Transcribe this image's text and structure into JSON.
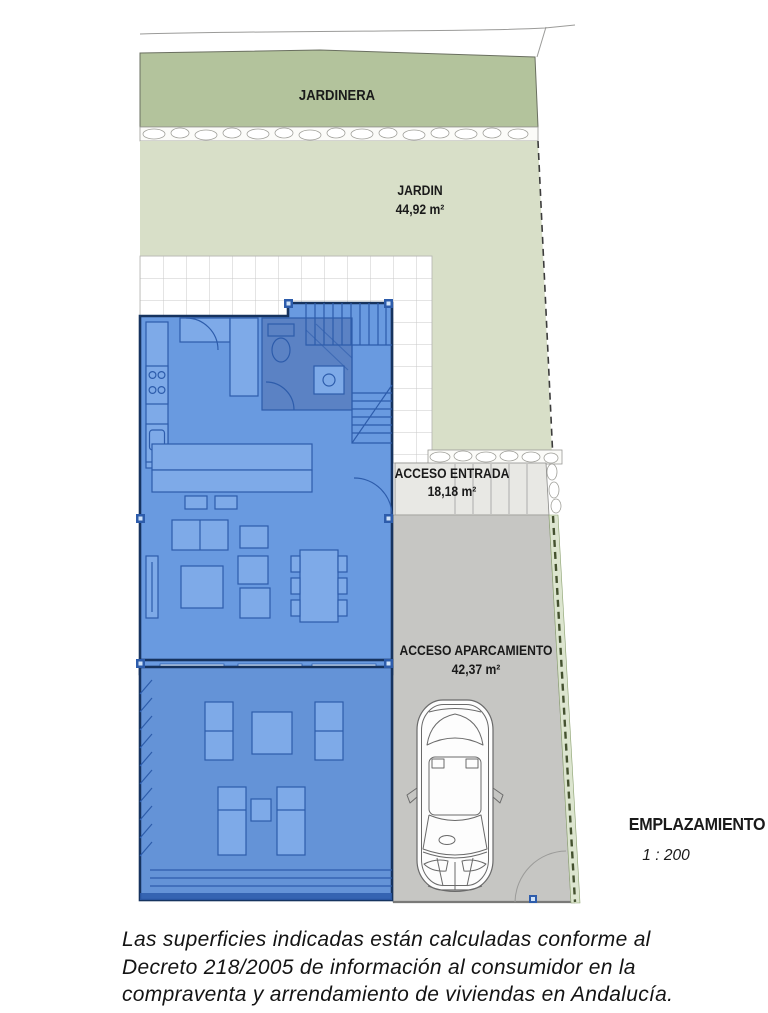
{
  "title": "EMPLAZAMIENTO",
  "scale": "1 : 200",
  "areas": {
    "jardinera": {
      "label": "JARDINERA"
    },
    "jardin": {
      "label": "JARDIN",
      "area": "44,92 m²"
    },
    "acceso_entrada": {
      "label": "ACCESO ENTRADA",
      "area": "18,18 m²"
    },
    "acceso_aparcamiento": {
      "label": "ACCESO APARCAMIENTO",
      "area": "42,37 m²"
    }
  },
  "disclaimer": {
    "line1": "Las superficies indicadas están calculadas conforme al",
    "line2": "Decreto 218/2005 de información al consumidor en la",
    "line3": "compraventa y arrendamiento de viviendas en Andalucía."
  },
  "colors": {
    "jardinera_green": "#b3c39c",
    "jardin_green": "#d8dfc8",
    "house_blue": "#699ae0",
    "house_blue_dark": "#2d5cab",
    "wet_area_blue": "#5b82c4",
    "furniture_blue": "#7eaae8",
    "parking_gray": "#c6c6c3",
    "entrance_gray": "#e8e8e4",
    "hedge_green": "#dce5cf",
    "hedge_dark": "#44512f",
    "outline_dark": "#16335f",
    "text_dark": "#1a1a1a"
  }
}
